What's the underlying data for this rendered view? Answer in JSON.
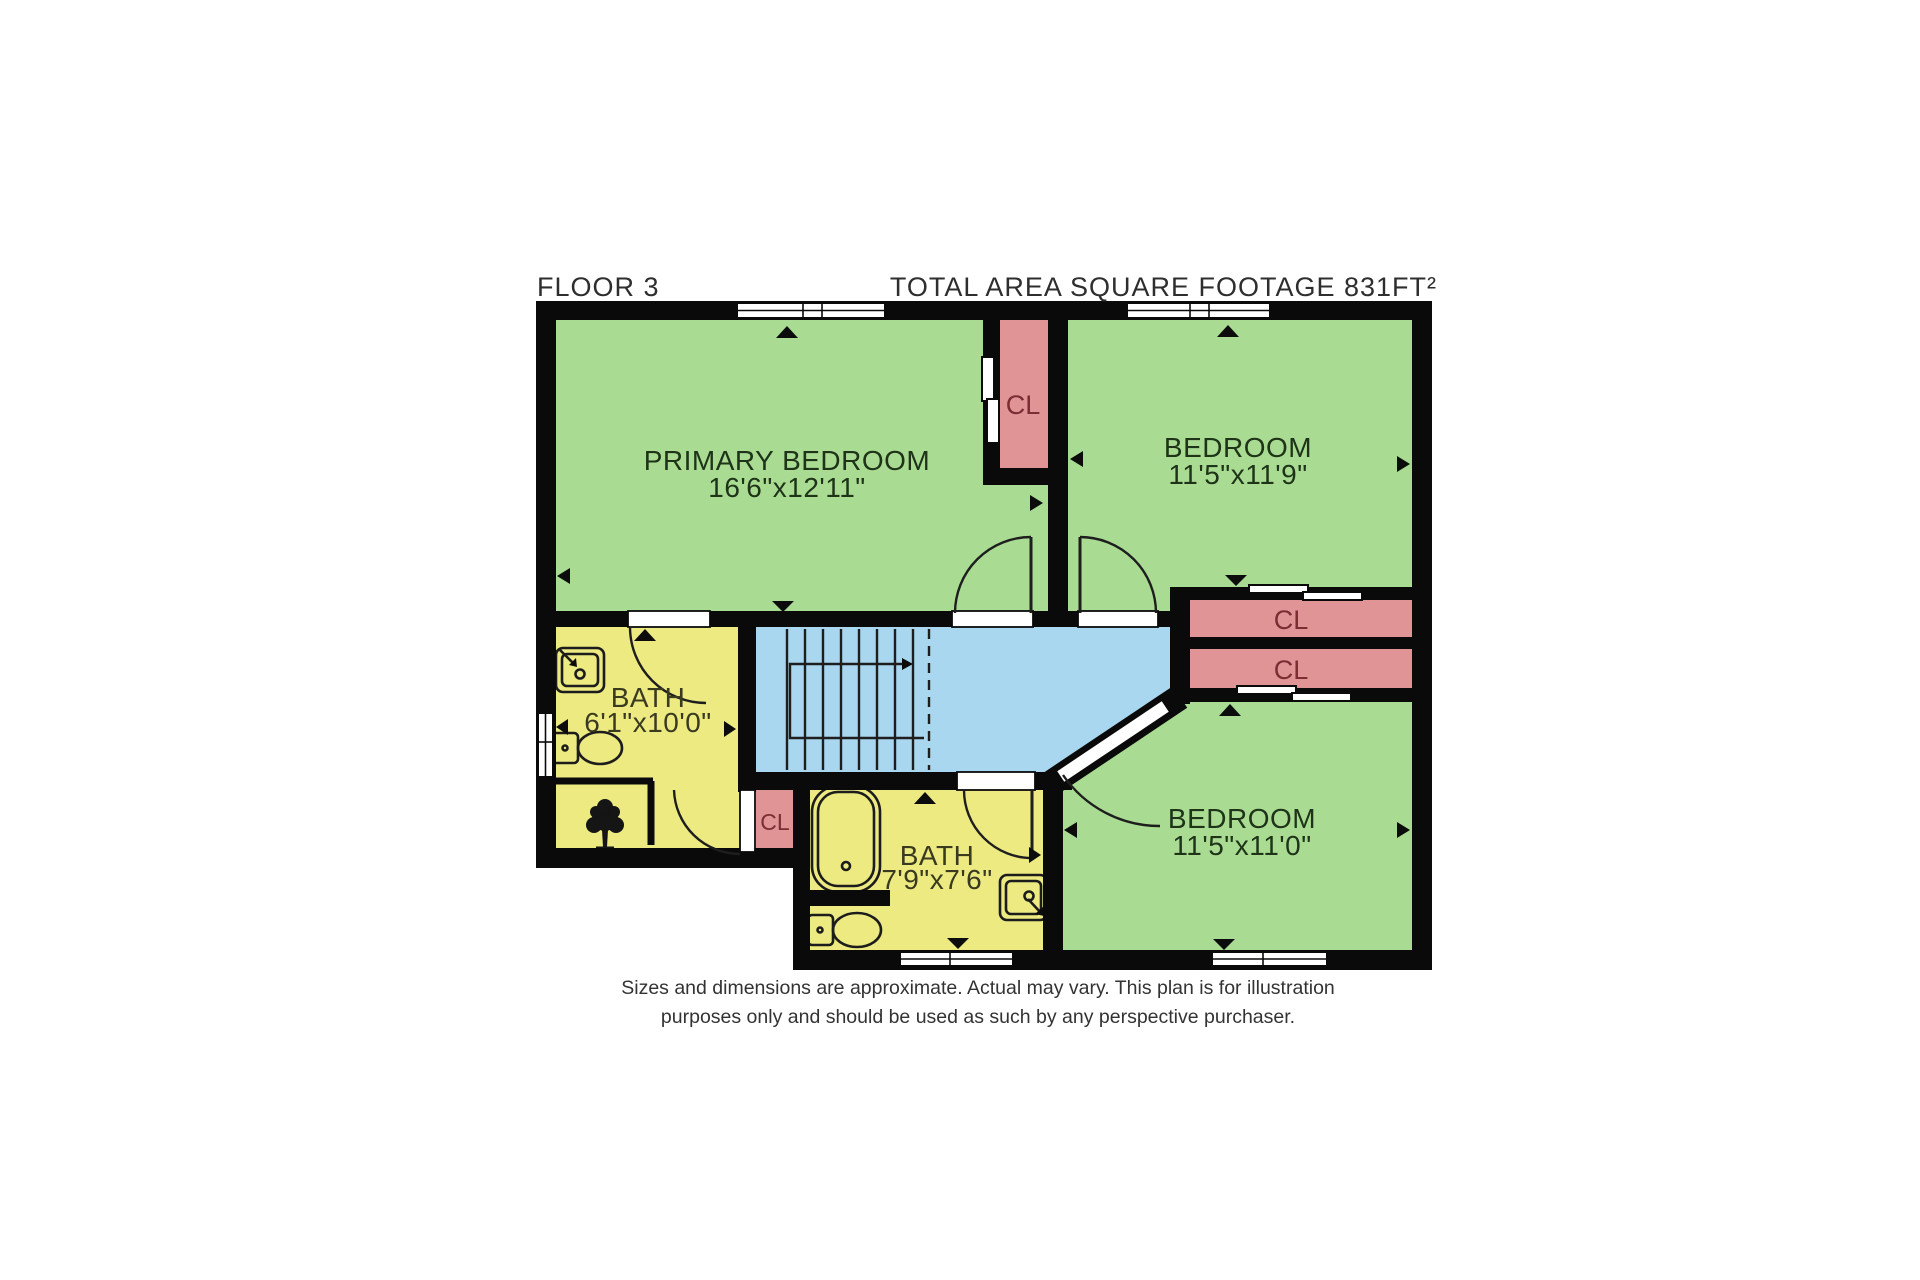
{
  "header": {
    "floor_label": "FLOOR 3",
    "area_label": "TOTAL AREA SQUARE FOOTAGE 831FT²"
  },
  "rooms": {
    "primary_bedroom": {
      "name": "PRIMARY BEDROOM",
      "dimensions": "16'6\"x12'11\""
    },
    "bedroom_top_right": {
      "name": "BEDROOM",
      "dimensions": "11'5\"x11'9\""
    },
    "bedroom_bottom_right": {
      "name": "BEDROOM",
      "dimensions": "11'5\"x11'0\""
    },
    "bath_left": {
      "name": "BATH",
      "dimensions": "6'1\"x10'0\""
    },
    "bath_bottom": {
      "name": "BATH",
      "dimensions": "7'9\"x7'6\""
    }
  },
  "closets": {
    "top_middle": {
      "label": "CL"
    },
    "right_upper": {
      "label": "CL"
    },
    "right_lower": {
      "label": "CL"
    },
    "hall_nook": {
      "label": "CL"
    }
  },
  "footer": {
    "line1": "Sizes and dimensions are approximate. Actual may vary. This plan is for illustration",
    "line2": "purposes only and should be used as such by any perspective purchaser."
  },
  "colors": {
    "wall": "#0a0a0a",
    "room-green": "#a9dc92",
    "room-yellow": "#edea82",
    "room-blue": "#a8d7ef",
    "room-pink": "#e09496",
    "title-text": "#2e2e2e",
    "bedroom-text": "#1e3318",
    "bath-text": "#3a3a20",
    "closet-text": "#7c2d33",
    "footer-text": "#333333"
  }
}
